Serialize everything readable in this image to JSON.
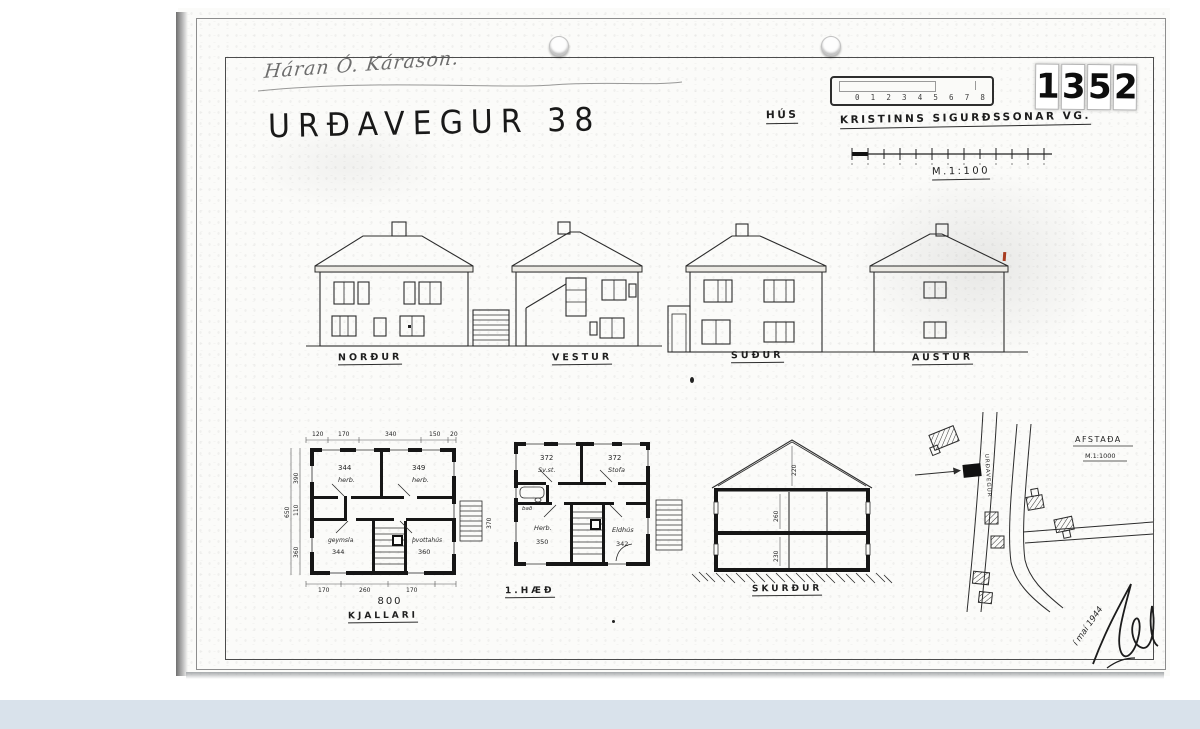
{
  "header": {
    "handwritten_name": "Háran Ó. Kárason.",
    "title": "URÐAVEGUR 38",
    "stamp_digits": [
      "1",
      "3",
      "5",
      "2"
    ],
    "ruler_digits": [
      "0",
      "1",
      "2",
      "3",
      "4",
      "5",
      "6",
      "7",
      "8"
    ],
    "owner_label": "HÚS",
    "owner_name": "KRISTINNS SIGURÐSSONAR VG.",
    "scale_label": "M.1:100"
  },
  "elevations": [
    {
      "label": "NORÐUR"
    },
    {
      "label": "VESTUR"
    },
    {
      "label": "SUÐUR"
    },
    {
      "label": "AUSTUR"
    }
  ],
  "basement": {
    "label": "KJALLARI",
    "total_width": "800",
    "dims_top": [
      "120",
      "170",
      "340",
      "150",
      "20"
    ],
    "dims_left": [
      "390",
      "110",
      "360"
    ],
    "dim_left_total": "650",
    "dims_bottom": [
      "170",
      "260",
      "170"
    ],
    "dim_stairs": "370",
    "rooms": [
      {
        "num": "344",
        "name": "herb."
      },
      {
        "num": "349",
        "name": "herb."
      },
      {
        "name": "geymsla",
        "num": "344"
      },
      {
        "name": "þvottahús",
        "num": "360"
      }
    ]
  },
  "floor1": {
    "label": "1.HÆÐ",
    "rooms": [
      {
        "num": "372",
        "name": "Sv.st."
      },
      {
        "num": "372",
        "name": "Stofa"
      },
      {
        "name": "bað"
      },
      {
        "name": "Herb.",
        "num": "350"
      },
      {
        "name": "Eldhús",
        "num": "342"
      }
    ]
  },
  "section": {
    "label": "SKURÐUR",
    "dim_attic": "220",
    "dim_upper": "260",
    "dim_lower": "230"
  },
  "site": {
    "title": "AFSTAÐA",
    "scale": "M.1:1000",
    "street": "URÐAVEGUR"
  },
  "footer": {
    "date_note": "í maí 1944"
  }
}
